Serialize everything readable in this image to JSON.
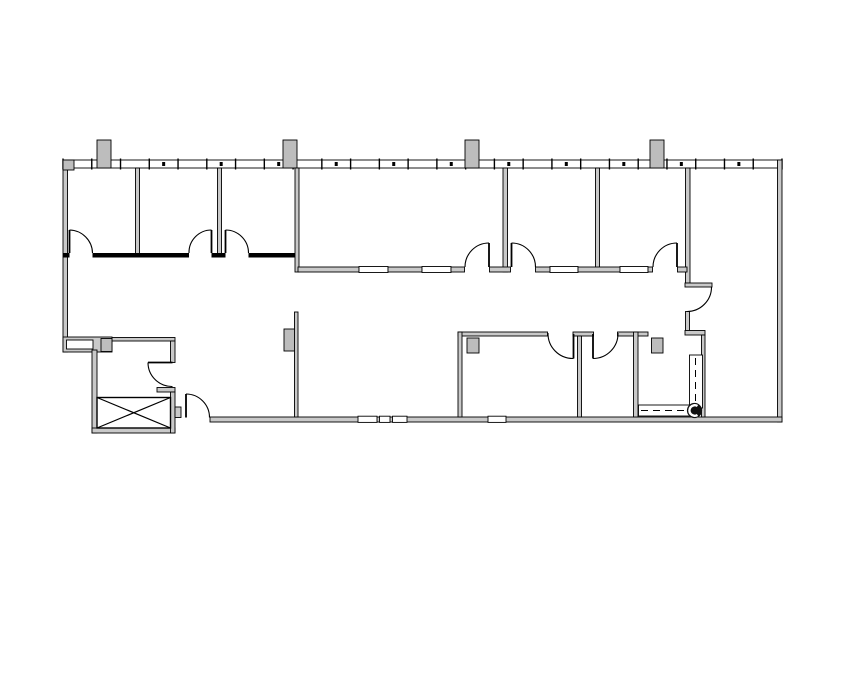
{
  "plan": {
    "kind": "architectural-floor-plan",
    "visible_text": "",
    "colors": {
      "background": "#ffffff",
      "wall_stroke": "#000000",
      "wall_fill": "#c9c9c9",
      "column_fill": "#bdbdbd",
      "glass_fill": "#ffffff",
      "symbol_fill": "#111111"
    },
    "window_wall": {
      "x_start": 63,
      "x_end": 782,
      "y_top": 158.5,
      "y_bottom": 169.5,
      "panel_count": 25,
      "dot_every": 2
    },
    "counts": {
      "top_row_rooms": 6,
      "bottom_row_rooms": 3,
      "door_swings": 11,
      "structural_columns": 9,
      "elevator_shaft": 1,
      "dashed_casework_runs": 2,
      "water_heater_symbol": 1
    }
  }
}
